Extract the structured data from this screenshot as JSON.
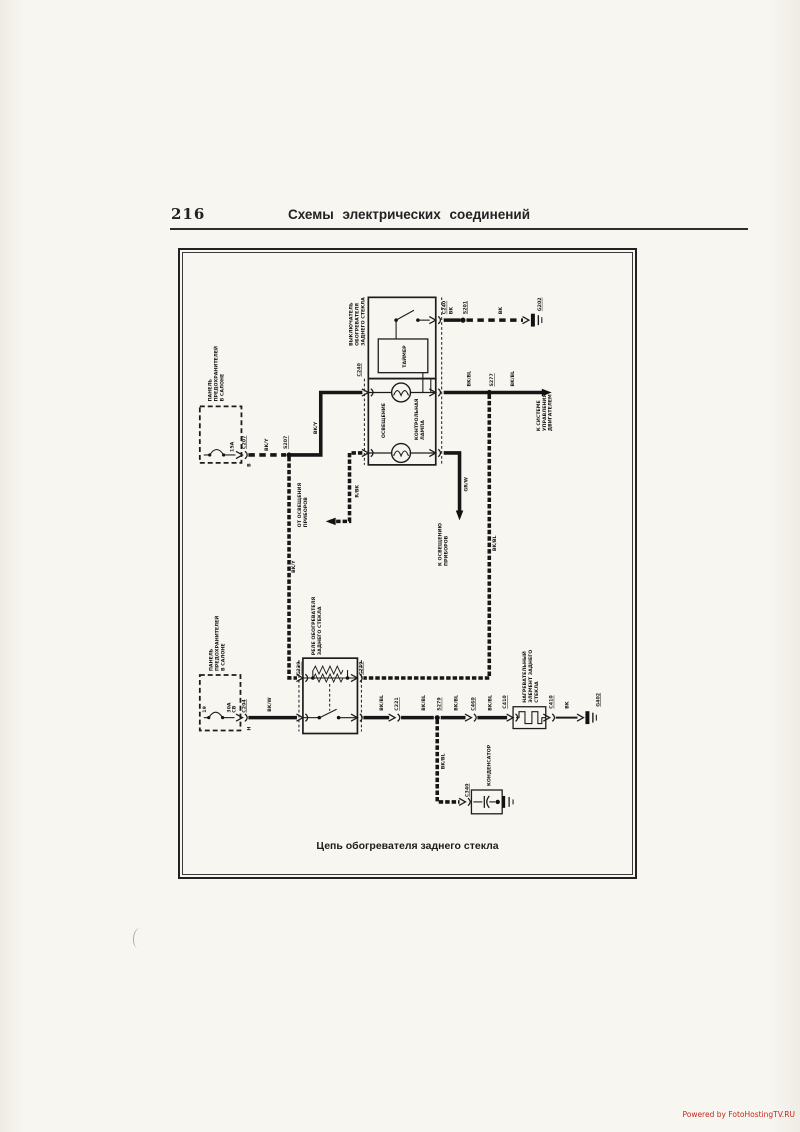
{
  "page": {
    "number": "216",
    "header_title": "Схемы электрических соединений",
    "caption": "Цепь обогревателя заднего стекла",
    "watermark": "Powered by FotoHostingTV.RU"
  },
  "colors": {
    "ink": "#1c1c1c",
    "paper": "#f8f6f1",
    "watermark_red": "#c4281a"
  },
  "components": {
    "switch": {
      "name_line1": "ВЫКЛЮЧАТЕЛЬ",
      "name_line2": "ОБОГРЕВАТЕЛЯ",
      "name_line3": "ЗАДНЕГО СТЕКЛА",
      "timer": "ТАЙМЕР",
      "lamp_illumination": "ОСВЕЩЕНИЕ",
      "lamp_control_line1": "КОНТРОЛЬНАЯ",
      "lamp_control_line2": "ЛАМПА"
    },
    "fuse_panel": {
      "line1": "ПАНЕЛЬ",
      "line2": "ПРЕДОХРАНИТЕЛЕЙ",
      "line3": "В САЛОНЕ"
    },
    "fuse_top": {
      "rating": "15A",
      "connector": "C207",
      "pin": "B"
    },
    "fuse_bottom": {
      "number": "19",
      "rating": "30A",
      "type": "CB",
      "connector": "C204",
      "pin": "H"
    },
    "relay": {
      "name_line1": "РЕЛЕ ОБОГРЕВАТЕЛЯ",
      "name_line2": "ЗАДНЕГО СТЕКЛА",
      "connector": "C239"
    },
    "heater_element": {
      "name_line1": "НАГРЕВАТЕЛЬНЫЙ",
      "name_line2": "ЭЛЕМЕНТ ЗАДНЕГО",
      "name_line3": "СТЕКЛА",
      "connector": "C410"
    },
    "capacitor": {
      "name": "КОНДЕНСАТОР",
      "connector": "C340"
    }
  },
  "connectors": {
    "c240": "C240",
    "c221": "C221",
    "c460": "C460"
  },
  "junctions": {
    "s201": "S201",
    "s207": "S207",
    "s277": "S277",
    "s279": "S279"
  },
  "grounds": {
    "g202": "G202",
    "g402": "G402"
  },
  "wires": {
    "bk": "BK",
    "bk_y": "BK/Y",
    "bk_bl": "BK/BL",
    "bk_w": "BK/W",
    "r_bk": "R/BK",
    "gr_w": "GR/W"
  },
  "destinations": {
    "engine_line1": "К СИСТЕМЕ",
    "engine_line2": "УПРАВЛЕНИЯ",
    "engine_line3": "ДВИГАТЕЛЕМ",
    "from_illumination_line1": "ОТ ОСВЕЩЕНИЯ",
    "from_illumination_line2": "ПРИБОРОВ",
    "to_illumination_line1": "К ОСВЕЩЕНИЮ",
    "to_illumination_line2": "ПРИБОРОВ"
  }
}
